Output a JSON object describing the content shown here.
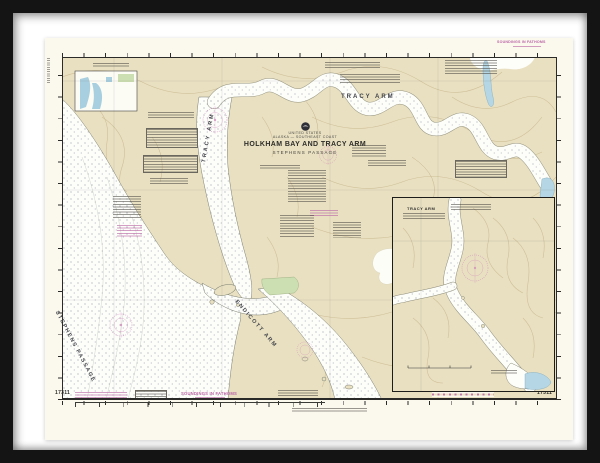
{
  "frame": {
    "frame_color": "#141414",
    "mat_color": "#ffffff"
  },
  "chart": {
    "paper_color": "#fbf8ee",
    "land_color": "#e9e0c2",
    "water_color": "#fdfdfa",
    "shallow_water_color": "#b5d6e4",
    "tidal_flats_color": "#ccdfb2",
    "contour_color": "#c8b88c",
    "magenta_color": "#bd6ca8",
    "header": {
      "country": "UNITED STATES",
      "region": "ALASKA — SOUTHEAST COAST",
      "title": "HOLKHAM BAY AND TRACY ARM",
      "subtitle": "STEPHENS PASSAGE"
    },
    "labels": {
      "tracy_arm": "TRACY ARM",
      "tracy_arm_fjord": "TRACY ARM",
      "endicott_arm": "ENDICOTT ARM",
      "stephens_passage": "STEPHENS PASSAGE"
    },
    "inset": {
      "title": "TRACY ARM"
    },
    "margin": {
      "chart_number_left": "17311",
      "chart_number_right": "17311",
      "soundings_note": "SOUNDINGS IN FATHOMS",
      "soundings_note_top": "SOUNDINGS IN FATHOMS"
    }
  }
}
